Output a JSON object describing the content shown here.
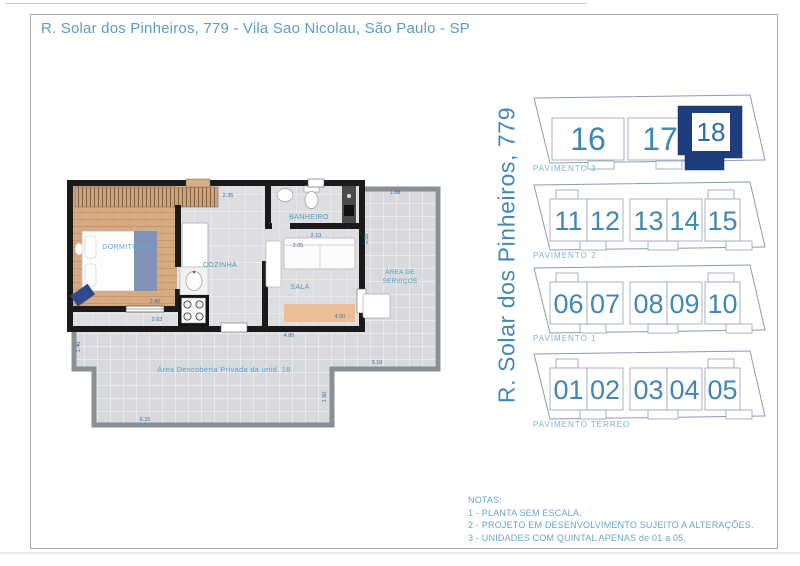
{
  "header": {
    "title": "R. Solar dos Pinheiros, 779 - Vila Sao Nicolau, São Paulo - SP"
  },
  "side_title": "R. Solar dos Pinheiros, 779",
  "floorplan": {
    "rooms": {
      "dormitorio": "DORMITÓRIO",
      "cozinha": "COZINHA",
      "banheiro": "BANHEIRO",
      "sala": "SALA",
      "servicos_line1": "ÁREA DE",
      "servicos_line2": "SERVIÇOS",
      "descoberta": "Área Descoberta Privada da unid. 18"
    },
    "dimensions": {
      "cozinha_top": "2.35",
      "banheiro_width": "2.13",
      "servicos_top": "1.88",
      "servicos_left": "3.55",
      "sala_top": "2.05",
      "sala_width": "4.50",
      "dormitorio_width": "2.40",
      "dormitorio_window": "2.63",
      "unit_width": "4.85",
      "terrace_right": "3.10",
      "terrace_bottom": "6.15",
      "terrace_left": "1.40",
      "terrace_inner": "1.50"
    }
  },
  "building": {
    "floors": [
      {
        "label": "PAVIMENTO 3",
        "units": [
          "16",
          "17",
          "18"
        ],
        "highlighted_unit": "18"
      },
      {
        "label": "PAVIMENTO 2",
        "units": [
          "11",
          "12",
          "13",
          "14",
          "15"
        ]
      },
      {
        "label": "PAVIMENTO 1",
        "units": [
          "06",
          "07",
          "08",
          "09",
          "10"
        ]
      },
      {
        "label": "PAVIMENTO TÉRREO",
        "units": [
          "01",
          "02",
          "03",
          "04",
          "05"
        ]
      }
    ]
  },
  "notes": {
    "heading": "NOTAS:",
    "items": [
      "1 - PLANTA SEM ESCALA.",
      "2 - PROJETO EM DESENVOLVIMENTO SUJEITO A ALTERAÇÕES.",
      "3 - UNIDADES COM QUINTAL APENAS de 01 a 05."
    ]
  },
  "colors": {
    "accent_blue": "#4187b5",
    "light_blue": "#7fb2d1",
    "title_blue": "#5b9fc4",
    "highlight_navy": "#1e3d7c",
    "wall_black": "#1a1a1a",
    "wall_gray": "#8a8f93"
  }
}
